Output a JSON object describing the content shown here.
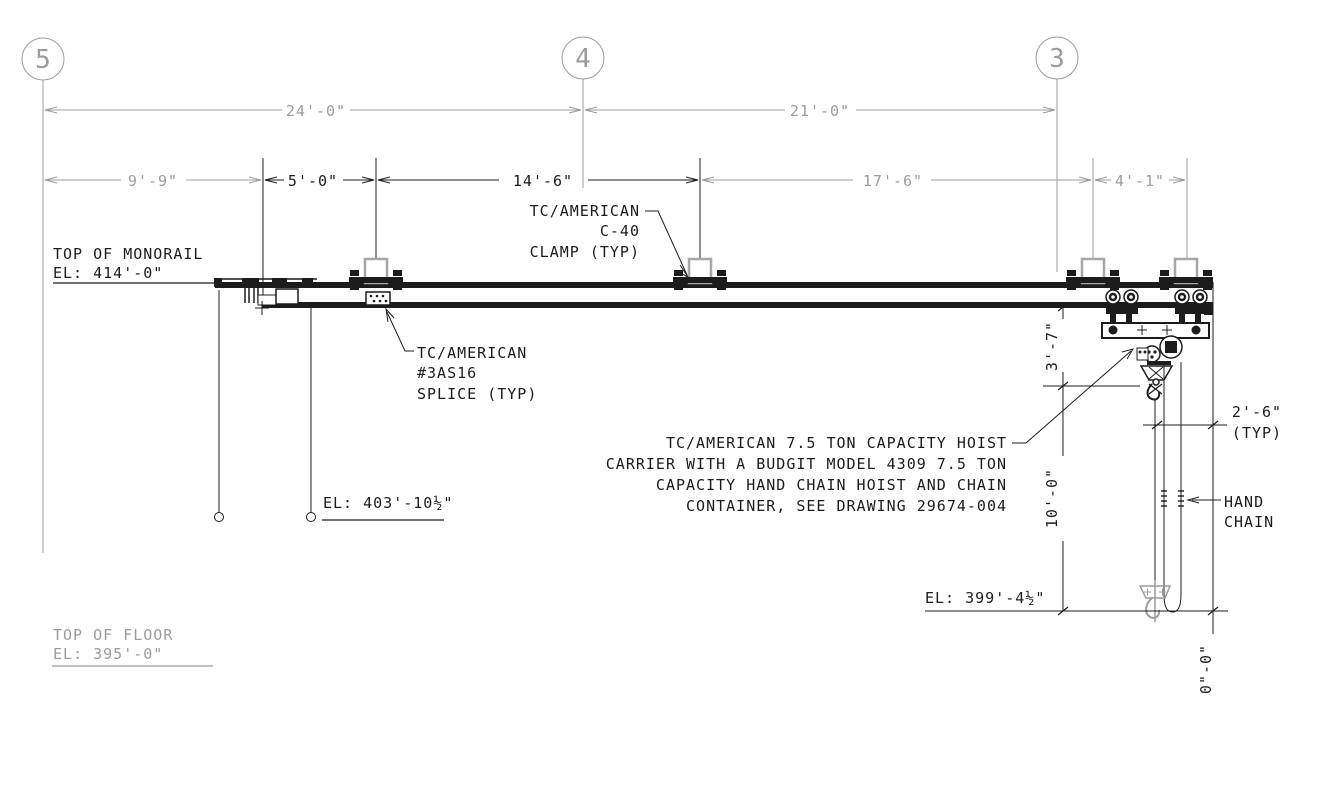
{
  "grids": [
    "5",
    "4",
    "3"
  ],
  "dims": {
    "top": [
      "24'-0\"",
      "21'-0\""
    ],
    "row2": [
      "9'-9\"",
      "5'-0\"",
      "14'-6\"",
      "17'-6\"",
      "4'-1\""
    ],
    "v37": "3'-7\"",
    "v100": "10'-0\"",
    "v00": "0\"-0\"",
    "typ": [
      "2'-6\"",
      "(TYP)"
    ]
  },
  "labels": {
    "monorail": [
      "TOP OF MONORAIL",
      "EL: 414'-0\""
    ],
    "clamp": [
      "TC/AMERICAN",
      "C-40",
      "CLAMP (TYP)"
    ],
    "splice": [
      "TC/AMERICAN",
      "#3AS16",
      "SPLICE (TYP)"
    ],
    "note": [
      "TC/AMERICAN 7.5 TON CAPACITY HOIST",
      "CARRIER WITH A BUDGIT MODEL 4309 7.5 TON",
      "CAPACITY HAND CHAIN HOIST AND CHAIN",
      "CONTAINER, SEE DRAWING 29674-004"
    ],
    "el_mid": "EL: 403'-10½\"",
    "el_low": "EL: 399'-4½\"",
    "hand": [
      "HAND",
      "CHAIN"
    ],
    "floor": [
      "TOP OF FLOOR",
      "EL: 395'-0\""
    ]
  },
  "colors": {
    "ink": "#1c1c1c",
    "gray": "#9c9c9c",
    "rod_gray": "#a6a6a6"
  }
}
